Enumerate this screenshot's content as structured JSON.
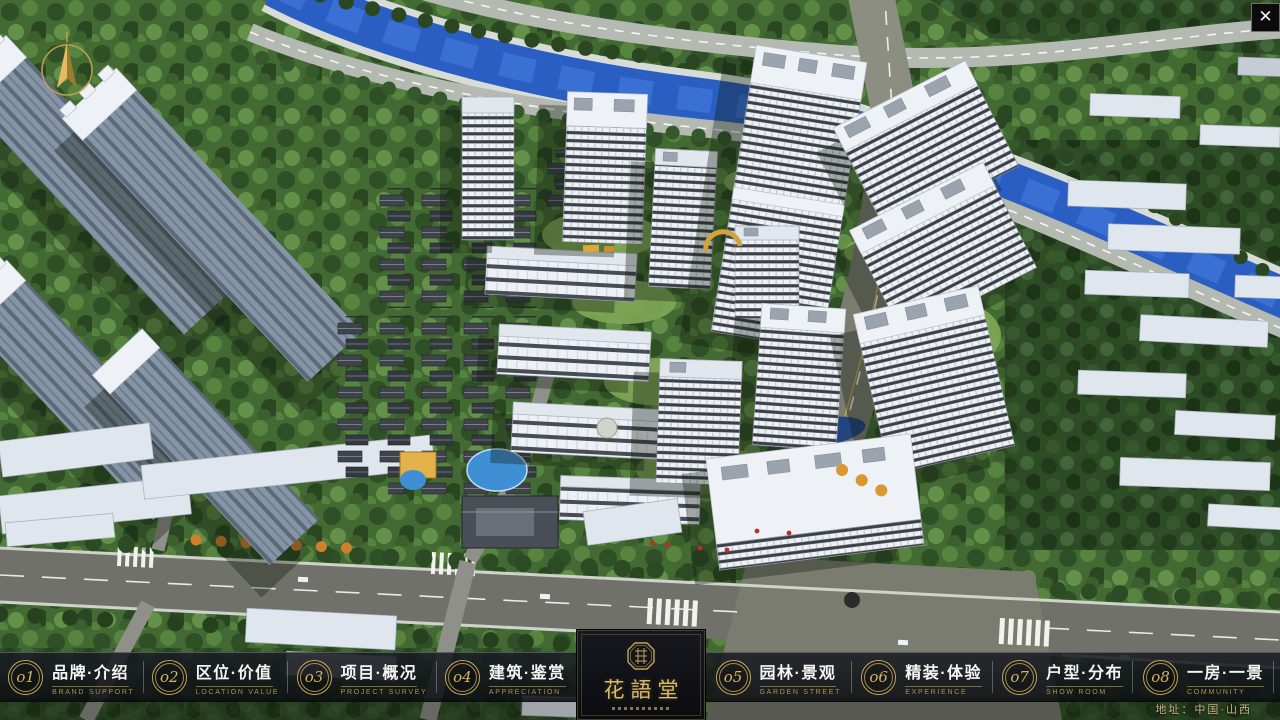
{
  "window": {
    "close_label": "✕"
  },
  "nav": {
    "items": [
      {
        "num": "o1",
        "zh": "品牌·介绍",
        "en": "BRAND SUPPORT"
      },
      {
        "num": "o2",
        "zh": "区位·价值",
        "en": "LOCATION VALUE"
      },
      {
        "num": "o3",
        "zh": "项目·概况",
        "en": "PROJECT SURVEY"
      },
      {
        "num": "o4",
        "zh": "建筑·鉴赏",
        "en": "APPRECIATION"
      },
      {
        "num": "o5",
        "zh": "园林·景观",
        "en": "GARDEN STREET"
      },
      {
        "num": "o6",
        "zh": "精装·体验",
        "en": "EXPERIENCE"
      },
      {
        "num": "o7",
        "zh": "户型·分布",
        "en": "SHOW ROOM"
      },
      {
        "num": "o8",
        "zh": "一房·一景",
        "en": "COMMUNITY"
      }
    ]
  },
  "logo": {
    "title": "花語堂"
  },
  "footer": {
    "address": "地址：中国·山西"
  },
  "colors": {
    "gold": "#c9a75d",
    "bar_bg": "rgba(16,18,23,0.87)",
    "river": "#2a5ec2"
  }
}
